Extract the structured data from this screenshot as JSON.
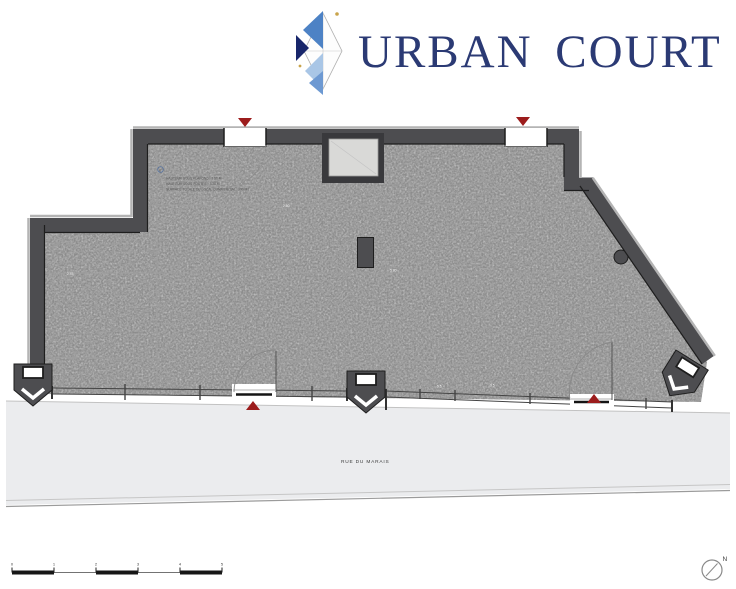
{
  "logo": {
    "wordmark": "URBAN COURT"
  },
  "colors": {
    "navy": "#2b3a74",
    "blue_mid": "#4d82c5",
    "blue_light": "#a9c6e6",
    "blue_deep": "#18266b",
    "blue_soft": "#6d99d2",
    "gold": "#c9a44b",
    "wall": "#4d4d50",
    "wall_dark": "#1e1e1e",
    "wall_shadow": "#b4b4b4",
    "floor": "#cacaca",
    "street": "#ebecee",
    "red": "#9c1c1c",
    "line_faint": "#9e9e9e"
  },
  "plan": {
    "street_label": "RUE DU MARAIS",
    "annotation": {
      "marker": "0",
      "lines": [
        "HAUTEUR SOUS PLAFOND : 3.50 M",
        "HAUTEUR SOUS POUTRE : 3.20 M",
        "SURFACE TOTALE DU LOCAL COMMERCIAL : 390 M2"
      ]
    },
    "dims": [
      "2.60",
      "2.45",
      "5.80",
      "5.5",
      "9.5"
    ]
  },
  "scale_bar": {
    "labels": [
      "0",
      "1",
      "2",
      "3",
      "4",
      "5"
    ]
  },
  "north": {
    "label": "N"
  }
}
